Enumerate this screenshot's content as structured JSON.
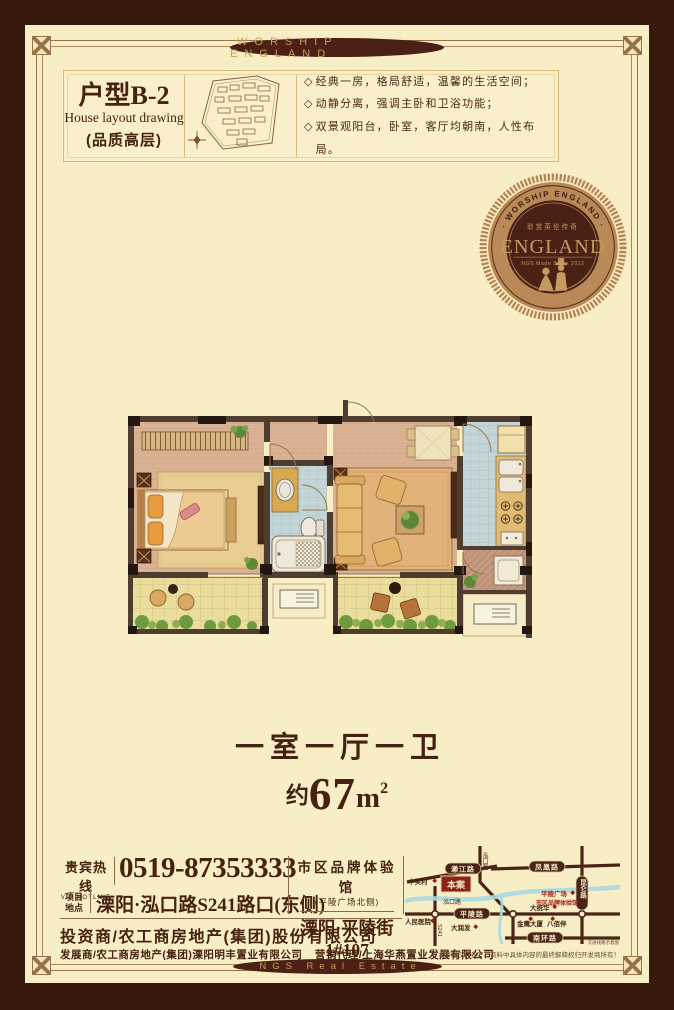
{
  "banners": {
    "top": "WORSHIP ENGLAND",
    "bottom": "NGS Real Estate"
  },
  "header": {
    "unit": "户型B-2",
    "unit_sub": "House layout drawing",
    "quality": "(品质高层)",
    "feature_marker": "◇",
    "features": [
      "经典一房，格局舒适，温馨的生活空间；",
      "动静分离，强调主卧和卫浴功能；",
      "双景观阳台，卧室，客厅均朝南，人性布局。"
    ]
  },
  "badge": {
    "arc_text": "· WORSHIP ENGLAND ·",
    "tagline_cn": "聆赏英伦传奇",
    "title": "ENGLAND",
    "subtitle": "NGS Made Since 2012"
  },
  "summary": {
    "rooms": "一室一厅一卫",
    "approx": "约",
    "area": "67",
    "unit": "m",
    "sup": "2"
  },
  "contact": {
    "hotline_cn": "贵宾热线",
    "hotline_en": "VIP HOTLINE",
    "hotline": "0519-87353333",
    "site_l1": "项目",
    "site_l2": "地点",
    "site": "溧阳·泓口路S241路口(东侧)",
    "showroom": "市区品牌体验馆",
    "showroom_note": "(平陵广场北侧)",
    "showroom_addr": "溧阳·平陵街1#107",
    "investor": "投资商/农工商房地产(集团)股份有限公司",
    "developer": "发展商/农工商房地产(集团)溧阳明丰置业有限公司",
    "agent": "营销代理/上海华燕置业发展有限公司",
    "disclaimer": "本资料仅供参考，资料中具体内容的最终解释权归开发商所有！"
  },
  "map": {
    "roads": {
      "laijiang": "濑江路",
      "fenghuang": "凤凰路",
      "pingling": "平陵路",
      "nanhuan": "南环路",
      "kunlun": "昆仑路",
      "hongkou_v": "泓口路",
      "hongkou_h": "泓口路",
      "s241": "S241"
    },
    "site": "本案",
    "pois": {
      "zgc": "中关村",
      "hospital": "人民医院",
      "drf": "大润发",
      "jinying": "金鹰大厦",
      "bbb": "八佰伴",
      "dth": "大统华",
      "plaza": "平陵广场",
      "exp": "市区品牌体验馆"
    },
    "caption": "交通线路示意图"
  },
  "colors": {
    "frame": "#38190e",
    "cream": "#f8eec6",
    "dark_text": "#46220f",
    "accent_tan": "#c89a5e",
    "badge_ring": "#b78352",
    "map_red": "#8a2418"
  }
}
